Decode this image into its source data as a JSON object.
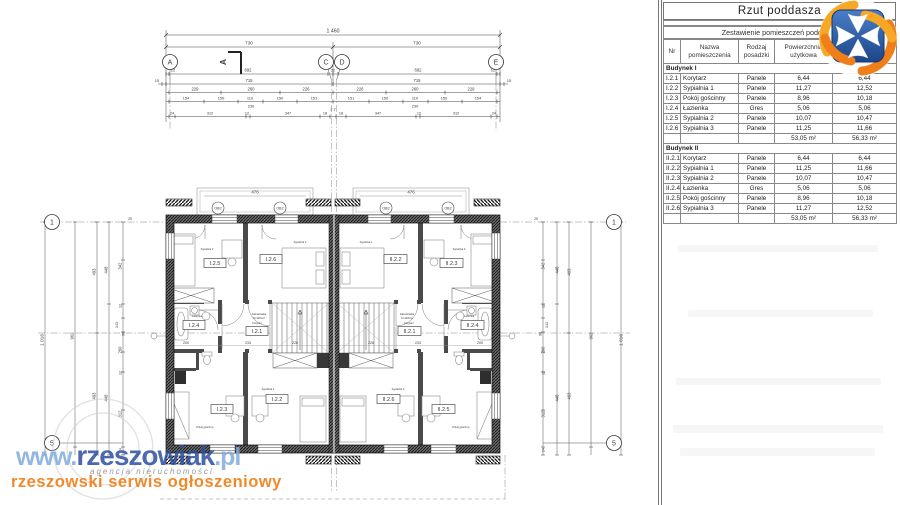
{
  "panel": {
    "title": "Rzut poddasza",
    "subtitle": "Zestawienie pomieszczeń poddasza",
    "headers": [
      "Nr",
      "Nazwa pomieszczenia",
      "Rodzaj posadzki",
      "Powierzchnia użytkowa",
      "Powierzchnia podłogi"
    ],
    "sections": [
      {
        "label": "Budynek I",
        "rows": [
          [
            "I.2.1",
            "Korytarz",
            "Panele",
            "6,44",
            "6,44"
          ],
          [
            "I.2.2",
            "Sypialnia 1",
            "Panele",
            "11,27",
            "12,52"
          ],
          [
            "I.2.3",
            "Pokój gościnny",
            "Panele",
            "8,96",
            "10,18"
          ],
          [
            "I.2.4",
            "Łazienka",
            "Gres",
            "5,06",
            "5,06"
          ],
          [
            "I.2.5",
            "Sypialnia 2",
            "Panele",
            "10,07",
            "10,47"
          ],
          [
            "I.2.6",
            "Sypialnia 3",
            "Panele",
            "11,25",
            "11,66"
          ]
        ],
        "sum": [
          "53,05 m²",
          "56,33 m²"
        ]
      },
      {
        "label": "Budynek II",
        "rows": [
          [
            "II.2.1",
            "Korytarz",
            "Panele",
            "6,44",
            "6,44"
          ],
          [
            "II.2.2",
            "Sypialnia 1",
            "Panele",
            "11,25",
            "11,66"
          ],
          [
            "II.2.3",
            "Sypialnia 2",
            "Panele",
            "10,07",
            "10,47"
          ],
          [
            "II.2.4",
            "Łazienka",
            "Gres",
            "5,06",
            "5,06"
          ],
          [
            "II.2.5",
            "Pokój gościnny",
            "Panele",
            "8,96",
            "10,18"
          ],
          [
            "II.2.6",
            "Sypialnia 3",
            "Panele",
            "11,27",
            "12,52"
          ]
        ],
        "sum": [
          "53,05 m²",
          "56,33 m²"
        ]
      }
    ]
  },
  "plan": {
    "bubbles": {
      "a": "A",
      "c": "C",
      "d": "D",
      "e": "E",
      "r1": "1",
      "r5": "5"
    },
    "section_mark": "A",
    "window_mark": "OB2",
    "dormer_dim": "476",
    "stair_note_1": "balustrada",
    "stair_note_2": "h=110cm",
    "dims": {
      "total": "1 460",
      "halves": [
        "730",
        "730"
      ],
      "row3": [
        "12",
        "692",
        "22",
        "692",
        "12"
      ],
      "side15": "15",
      "row4": [
        "715",
        "715"
      ],
      "row5": [
        "229",
        "260",
        "226",
        "226",
        "260",
        "229"
      ],
      "row6": [
        "154",
        "150",
        "110",
        "150",
        "151",
        "151",
        "150",
        "110",
        "150",
        "154"
      ],
      "row6b": [
        "230",
        "230"
      ],
      "row7": [
        "24",
        "312",
        "12",
        "347",
        "18",
        "2 2",
        "18",
        "347",
        "12",
        "312",
        "24"
      ],
      "left": {
        "total": "1 016",
        "l2": "962",
        "l3": [
          "493",
          "493"
        ],
        "l4": [
          "448",
          "448"
        ],
        "l5": [
          "342",
          "12",
          "143",
          "90",
          "260",
          "12",
          "312",
          "24"
        ],
        "top": "25"
      },
      "inner": [
        "200",
        "233",
        "226",
        "226",
        "233",
        "200"
      ]
    },
    "rooms": [
      {
        "id": "I.2.5",
        "tag": "Sypialnia 2"
      },
      {
        "id": "I.2.6",
        "tag": "Sypialnia 3"
      },
      {
        "id": "I.2.4",
        "tag": "Łazienka"
      },
      {
        "id": "I.2.1",
        "tag": "Korytarz"
      },
      {
        "id": "I.2.3",
        "tag": "Pokój gościnny"
      },
      {
        "id": "I.2.2",
        "tag": "Sypialnia 1"
      },
      {
        "id": "II.2.2",
        "tag": "Sypialnia 1"
      },
      {
        "id": "II.2.3",
        "tag": "Sypialnia 2"
      },
      {
        "id": "II.2.1",
        "tag": "Korytarz"
      },
      {
        "id": "II.2.4",
        "tag": "Łazienka"
      },
      {
        "id": "II.2.6",
        "tag": "Sypialnia 3"
      },
      {
        "id": "II.2.5",
        "tag": "Pokój gościnny"
      }
    ]
  },
  "watermark": {
    "www": "www.",
    "name": "rzeszowiak",
    "tld": ".pl",
    "agency": "agencja nieruchomości",
    "tagline": "rzeszowski serwis ogłoszeniowy"
  },
  "colors": {
    "accent_orange": "#f08019",
    "brand_blue": "#2d50a0",
    "logo_blue": "#2a5ca8"
  }
}
